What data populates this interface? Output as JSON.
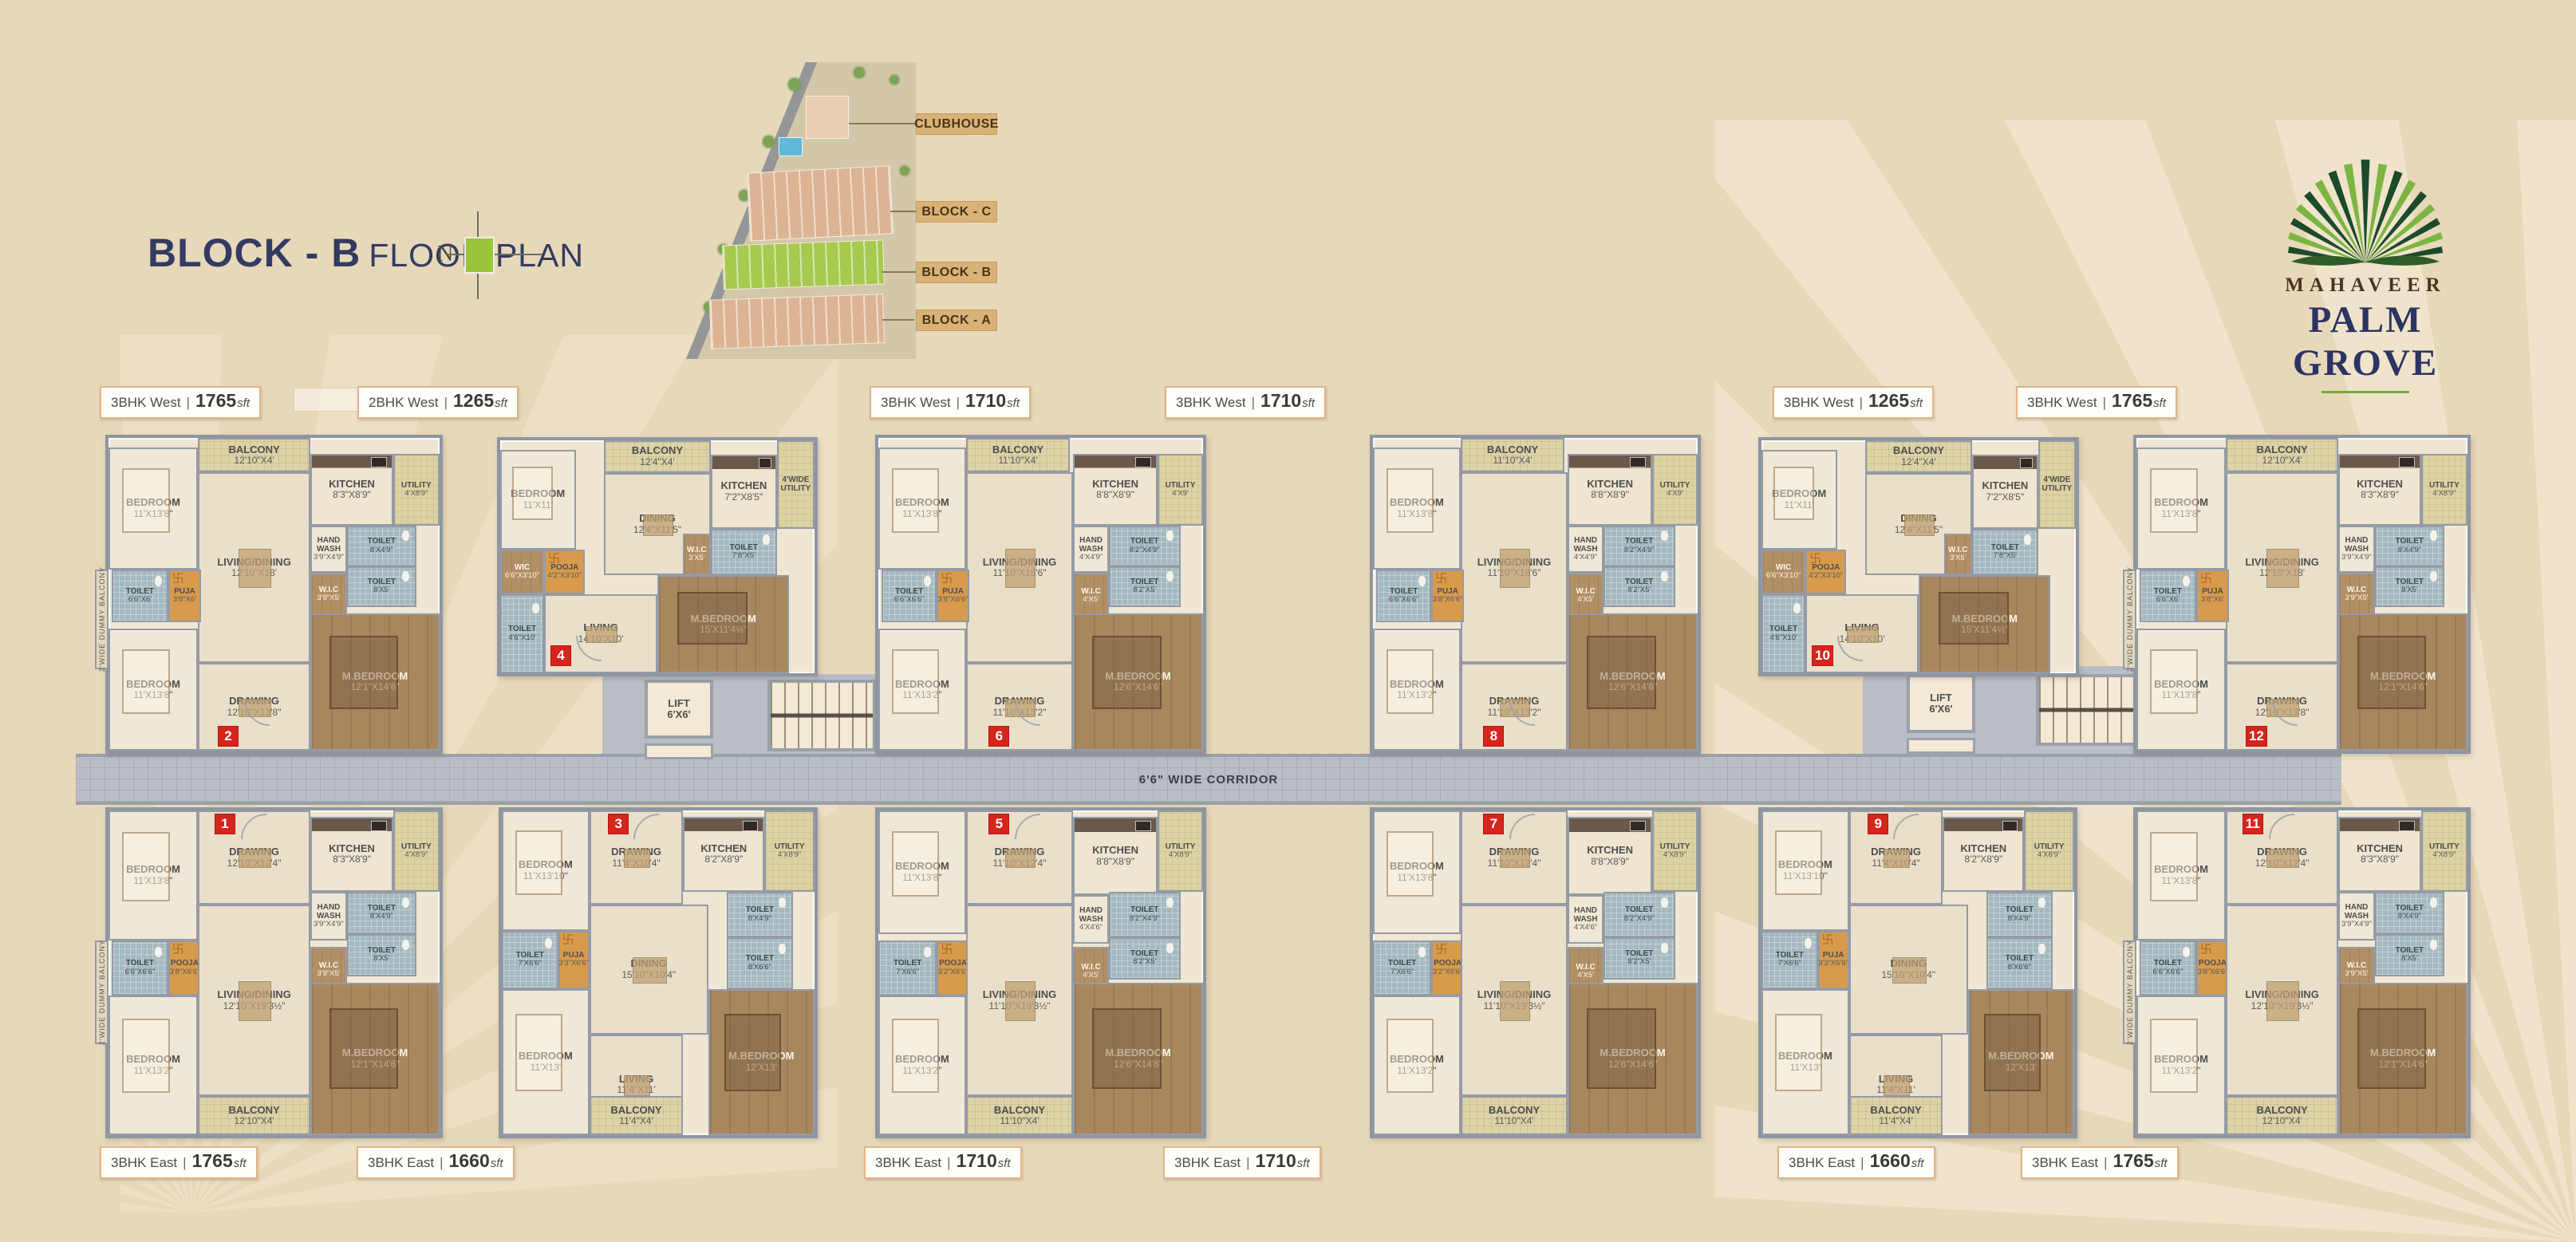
{
  "header": {
    "title_block": "BLOCK - B",
    "title_rest": "FLOOR PLAN",
    "north_label": "N"
  },
  "site_map": {
    "labels": [
      "CLUBHOUSE",
      "BLOCK - C",
      "BLOCK - B",
      "BLOCK - A"
    ]
  },
  "logo": {
    "brand": "MAHAVEER",
    "name": "PALM GROVE"
  },
  "corridor_label": "6'6\" WIDE CORRIDOR",
  "lift": {
    "name": "LIFT",
    "size": "6'X6'"
  },
  "label_sep": "|",
  "area_suffix": "sft",
  "colors": {
    "background": "#e8d8ba",
    "navy": "#323b62",
    "brand_green": "#76a93d",
    "badge_red": "#d6251d",
    "label_border": "#e0b488",
    "corridor_gray": "#b9bdc5",
    "map_label_tan": "#d8b276"
  },
  "designs": {
    "A": {
      "side_label": "2'WIDE DUMMY BALCONY",
      "rooms": [
        {
          "n": "BALCONY",
          "d": "12'10\"X4'"
        },
        {
          "n": "BEDROOM",
          "d": "11'X13'8\""
        },
        {
          "n": "LIVING/DINING",
          "d": "12'10\"X18'"
        },
        {
          "n": "KITCHEN",
          "d": "8'3\"X8'9\""
        },
        {
          "n": "UTILITY",
          "d": "4'X8'9\""
        },
        {
          "n": "HAND WASH",
          "d": "3'9\"X4'9\""
        },
        {
          "n": "TOILET",
          "d": "8'X4'9\""
        },
        {
          "n": "TOILET",
          "d": "6'6\"X6'"
        },
        {
          "n": "PUJA",
          "d": "3'8\"X6'"
        },
        {
          "n": "W.I.C",
          "d": "3'9\"X5'"
        },
        {
          "n": "TOILET",
          "d": "8'X5'"
        },
        {
          "n": "BEDROOM",
          "d": "11'X13'8\""
        },
        {
          "n": "DRAWING",
          "d": "12'10\"X13'8\""
        },
        {
          "n": "M.BEDROOM",
          "d": "12'1\"X14'6\""
        }
      ]
    },
    "B": {
      "side_label": "",
      "rooms": [
        {
          "n": "BALCONY",
          "d": "12'4\"X4'"
        },
        {
          "n": "BEDROOM",
          "d": "11'X11'"
        },
        {
          "n": "DINING",
          "d": "12'4\"X11'5\""
        },
        {
          "n": "KITCHEN",
          "d": "7'2\"X8'5\""
        },
        {
          "n": "4'WIDE UTILITY",
          "d": ""
        },
        {
          "n": "WIC",
          "d": "6'6\"X3'10\""
        },
        {
          "n": "POOJA",
          "d": "4'2\"X3'10\""
        },
        {
          "n": "TOILET",
          "d": "7'8\"X5'"
        },
        {
          "n": "W.I.C",
          "d": "3'X5'"
        },
        {
          "n": "M.BEDROOM",
          "d": "15'X11'4½\""
        },
        {
          "n": "LIVING",
          "d": "14'10\"X10'"
        },
        {
          "n": "TOILET",
          "d": "4'6\"X10'"
        }
      ]
    },
    "C": {
      "side_label": "",
      "rooms": [
        {
          "n": "BALCONY",
          "d": "11'10\"X4'"
        },
        {
          "n": "BEDROOM",
          "d": "11'X13'8\""
        },
        {
          "n": "LIVING/DINING",
          "d": "11'10\"X18'6\""
        },
        {
          "n": "KITCHEN",
          "d": "8'8\"X8'9\""
        },
        {
          "n": "UTILITY",
          "d": "4'X9'"
        },
        {
          "n": "HAND WASH",
          "d": "4'X4'9\""
        },
        {
          "n": "TOILET",
          "d": "8'2\"X4'9\""
        },
        {
          "n": "TOILET",
          "d": "6'6\"X6'6\""
        },
        {
          "n": "PUJA",
          "d": "3'8\"X6'6\""
        },
        {
          "n": "W.I.C",
          "d": "4'X5'"
        },
        {
          "n": "TOILET",
          "d": "8'2\"X5'"
        },
        {
          "n": "BEDROOM",
          "d": "11'X13'2\""
        },
        {
          "n": "DRAWING",
          "d": "11'10\"X13'2\""
        },
        {
          "n": "M.BEDROOM",
          "d": "12'6\"X14'6\""
        }
      ]
    },
    "D": {
      "side_label": "2'WIDE DUMMY BALCONY",
      "rooms": [
        {
          "n": "BEDROOM",
          "d": "11'X13'8\""
        },
        {
          "n": "DRAWING",
          "d": "12'10\"X12'4\""
        },
        {
          "n": "KITCHEN",
          "d": "8'3\"X8'9\""
        },
        {
          "n": "UTILITY",
          "d": "4'X8'9\""
        },
        {
          "n": "HAND WASH",
          "d": "3'9\"X4'9\""
        },
        {
          "n": "TOILET",
          "d": "8'X4'9\""
        },
        {
          "n": "TOILET",
          "d": "6'6\"X6'6\""
        },
        {
          "n": "POOJA",
          "d": "3'8\"X6'6\""
        },
        {
          "n": "W.I.C",
          "d": "3'9\"X5'"
        },
        {
          "n": "TOILET",
          "d": "8'X5'"
        },
        {
          "n": "BEDROOM",
          "d": "11'X13'2\""
        },
        {
          "n": "LIVING/DINING",
          "d": "12'10\"X19'3½\""
        },
        {
          "n": "M.BEDROOM",
          "d": "12'1\"X14'6\""
        },
        {
          "n": "BALCONY",
          "d": "12'10\"X4'"
        }
      ]
    },
    "E": {
      "side_label": "",
      "rooms": [
        {
          "n": "BEDROOM",
          "d": "11'X13'10\""
        },
        {
          "n": "DRAWING",
          "d": "11'4\"X10'4\""
        },
        {
          "n": "KITCHEN",
          "d": "8'2\"X8'9\""
        },
        {
          "n": "UTILITY",
          "d": "4'X8'9\""
        },
        {
          "n": "TOILET",
          "d": "8'X4'9\""
        },
        {
          "n": "TOILET",
          "d": "7'X6'6\""
        },
        {
          "n": "PUJA",
          "d": "3'3\"X6'6\""
        },
        {
          "n": "DINING",
          "d": "15'10\"X10'4\""
        },
        {
          "n": "TOILET",
          "d": "8'X6'6\""
        },
        {
          "n": "BEDROOM",
          "d": "11'X13'"
        },
        {
          "n": "LIVING",
          "d": "11'4\"X11'"
        },
        {
          "n": "M.BEDROOM",
          "d": "12'X13'"
        },
        {
          "n": "BALCONY",
          "d": "11'4\"X4'"
        }
      ]
    },
    "F": {
      "side_label": "",
      "rooms": [
        {
          "n": "BEDROOM",
          "d": "11'X13'8\""
        },
        {
          "n": "DRAWING",
          "d": "11'10\"X12'4\""
        },
        {
          "n": "KITCHEN",
          "d": "8'8\"X8'9\""
        },
        {
          "n": "UTILITY",
          "d": "4'X8'9\""
        },
        {
          "n": "HAND WASH",
          "d": "4'X4'6\""
        },
        {
          "n": "TOILET",
          "d": "8'2\"X4'9\""
        },
        {
          "n": "TOILET",
          "d": "7'X6'6\""
        },
        {
          "n": "POOJA",
          "d": "3'2\"X6'6\""
        },
        {
          "n": "W.I.C",
          "d": "4'X5'"
        },
        {
          "n": "TOILET",
          "d": "8'2\"X5'"
        },
        {
          "n": "BEDROOM",
          "d": "11'X13'2\""
        },
        {
          "n": "LIVING/DINING",
          "d": "11'10\"X19'3½\""
        },
        {
          "n": "M.BEDROOM",
          "d": "12'6\"X14'6\""
        },
        {
          "n": "BALCONY",
          "d": "11'10\"X4'"
        }
      ]
    }
  },
  "units": [
    {
      "number": "2",
      "type": "3BHK West",
      "area": "1765",
      "design": "A"
    },
    {
      "number": "4",
      "type": "2BHK West",
      "area": "1265",
      "design": "B"
    },
    {
      "number": "6",
      "type": "3BHK West",
      "area": "1710",
      "design": "C"
    },
    {
      "number": "8",
      "type": "3BHK West",
      "area": "1710",
      "design": "C"
    },
    {
      "number": "10",
      "type": "3BHK West",
      "area": "1265",
      "design": "B"
    },
    {
      "number": "12",
      "type": "3BHK West",
      "area": "1765",
      "design": "A"
    },
    {
      "number": "1",
      "type": "3BHK East",
      "area": "1765",
      "design": "D"
    },
    {
      "number": "3",
      "type": "3BHK East",
      "area": "1660",
      "design": "E"
    },
    {
      "number": "5",
      "type": "3BHK East",
      "area": "1710",
      "design": "F"
    },
    {
      "number": "7",
      "type": "3BHK East",
      "area": "1710",
      "design": "F"
    },
    {
      "number": "9",
      "type": "3BHK East",
      "area": "1660",
      "design": "E"
    },
    {
      "number": "11",
      "type": "3BHK East",
      "area": "1765",
      "design": "D"
    }
  ]
}
